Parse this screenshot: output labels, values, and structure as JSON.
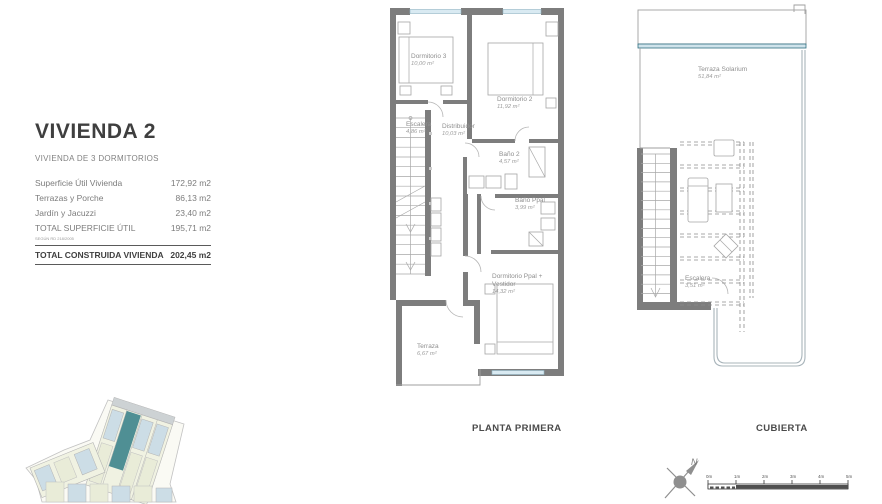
{
  "info_panel": {
    "title": "VIVIENDA 2",
    "subtitle": "VIVIENDA DE 3 DORMITORIOS",
    "rows": [
      {
        "label": "Superficie Útil Vivienda",
        "value": "172,92 m2"
      },
      {
        "label": "Terrazas y Porche",
        "value": "86,13 m2"
      },
      {
        "label": "Jardín y Jacuzzi",
        "value": "23,40 m2"
      },
      {
        "label": "TOTAL SUPERFICIE ÚTIL",
        "note": "SEGÚN RD 218/2005",
        "value": "195,71 m2"
      },
      {
        "label": "TOTAL CONSTRUIDA VIVIENDA",
        "value": "202,45 m2"
      }
    ]
  },
  "planta_primera": {
    "caption": "PLANTA PRIMERA",
    "rooms": {
      "dormitorio3": {
        "name": "Dormitorio 3",
        "area": "10,00 m²"
      },
      "dormitorio2": {
        "name": "Dormitorio 2",
        "area": "11,92 m²"
      },
      "escalera": {
        "name": "Escalera",
        "area": "4,86 m²"
      },
      "distribuidor": {
        "name": "Distribuidor",
        "area": "10,03 m²"
      },
      "bano2": {
        "name": "Baño 2",
        "area": "4,57 m²"
      },
      "banoppal": {
        "name": "Baño Ppal",
        "area": "3,99 m²"
      },
      "dormppal": {
        "name": "Dormitorio Ppal + Vestidor",
        "area": "14,32 m²"
      },
      "terraza": {
        "name": "Terraza",
        "area": "6,67 m²"
      }
    }
  },
  "cubierta": {
    "caption": "CUBIERTA",
    "rooms": {
      "solarium": {
        "name": "Terraza Solarium",
        "area": "51,84 m²"
      },
      "escalera": {
        "name": "Escalera",
        "area": "3,51 m²"
      }
    }
  },
  "compass": {
    "label": "N"
  },
  "scalebar": {
    "ticks": [
      "0m",
      "1m",
      "2m",
      "3m",
      "4m",
      "5m"
    ]
  },
  "colors": {
    "wall": "#7d7d7d",
    "glazing": "#d9eaf2",
    "teal_accent": "#2f6f80",
    "highlight_unit": "#4f8f94"
  }
}
